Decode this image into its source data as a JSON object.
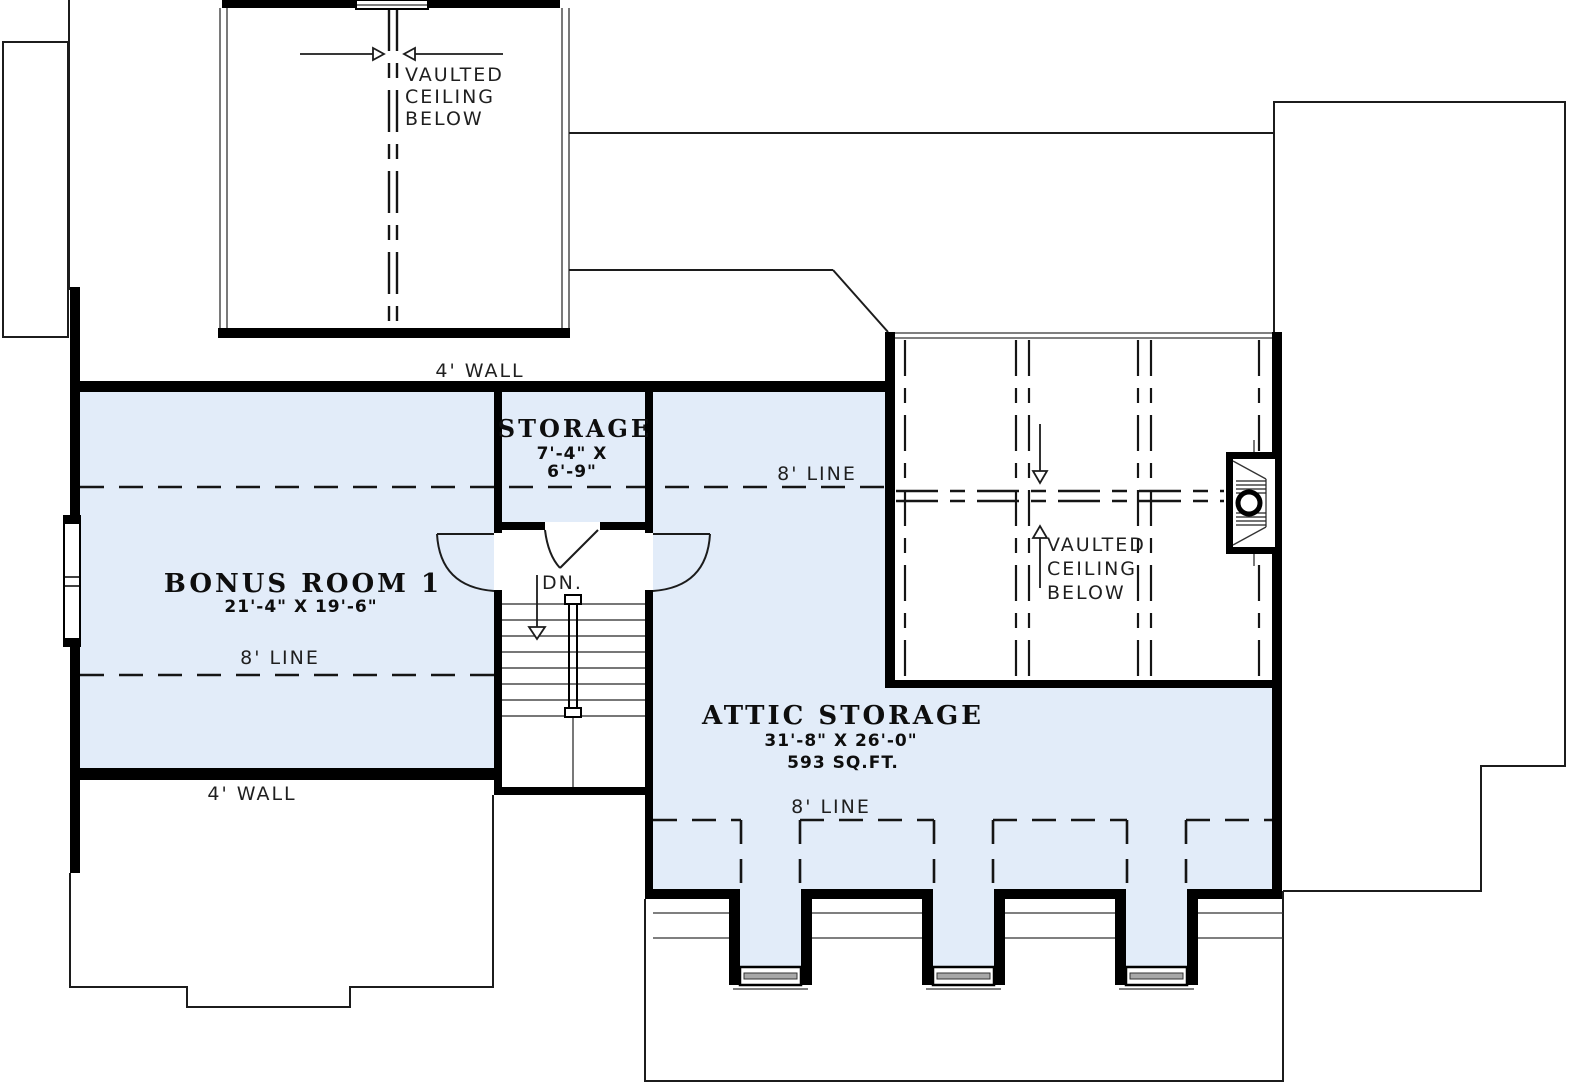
{
  "title": "Second floor plan with bonus room and attic storage",
  "colors": {
    "room_fill": "#e2ecf9",
    "wall": "#000000",
    "text": "#1f1f1f"
  },
  "labels": {
    "wall_top": "4' WALL",
    "wall_bottom": "4' WALL",
    "line_upper": "8' LINE",
    "line_bonus": "8' LINE",
    "line_attic": "8' LINE",
    "down": "DN.",
    "vaulted_top": [
      "VAULTED",
      "CEILING",
      "BELOW"
    ],
    "vaulted_right": [
      "VAULTED",
      "CEILING",
      "BELOW"
    ]
  },
  "rooms": {
    "bonus": {
      "name": "BONUS ROOM 1",
      "dims": "21'-4\" X 19'-6\""
    },
    "storage": {
      "name": "STORAGE",
      "dims1": "7'-4\" X",
      "dims2": "6'-9\""
    },
    "attic": {
      "name": "ATTIC STORAGE",
      "dims": "31'-8\" X 26'-0\"",
      "area": "593 SQ.FT."
    }
  }
}
